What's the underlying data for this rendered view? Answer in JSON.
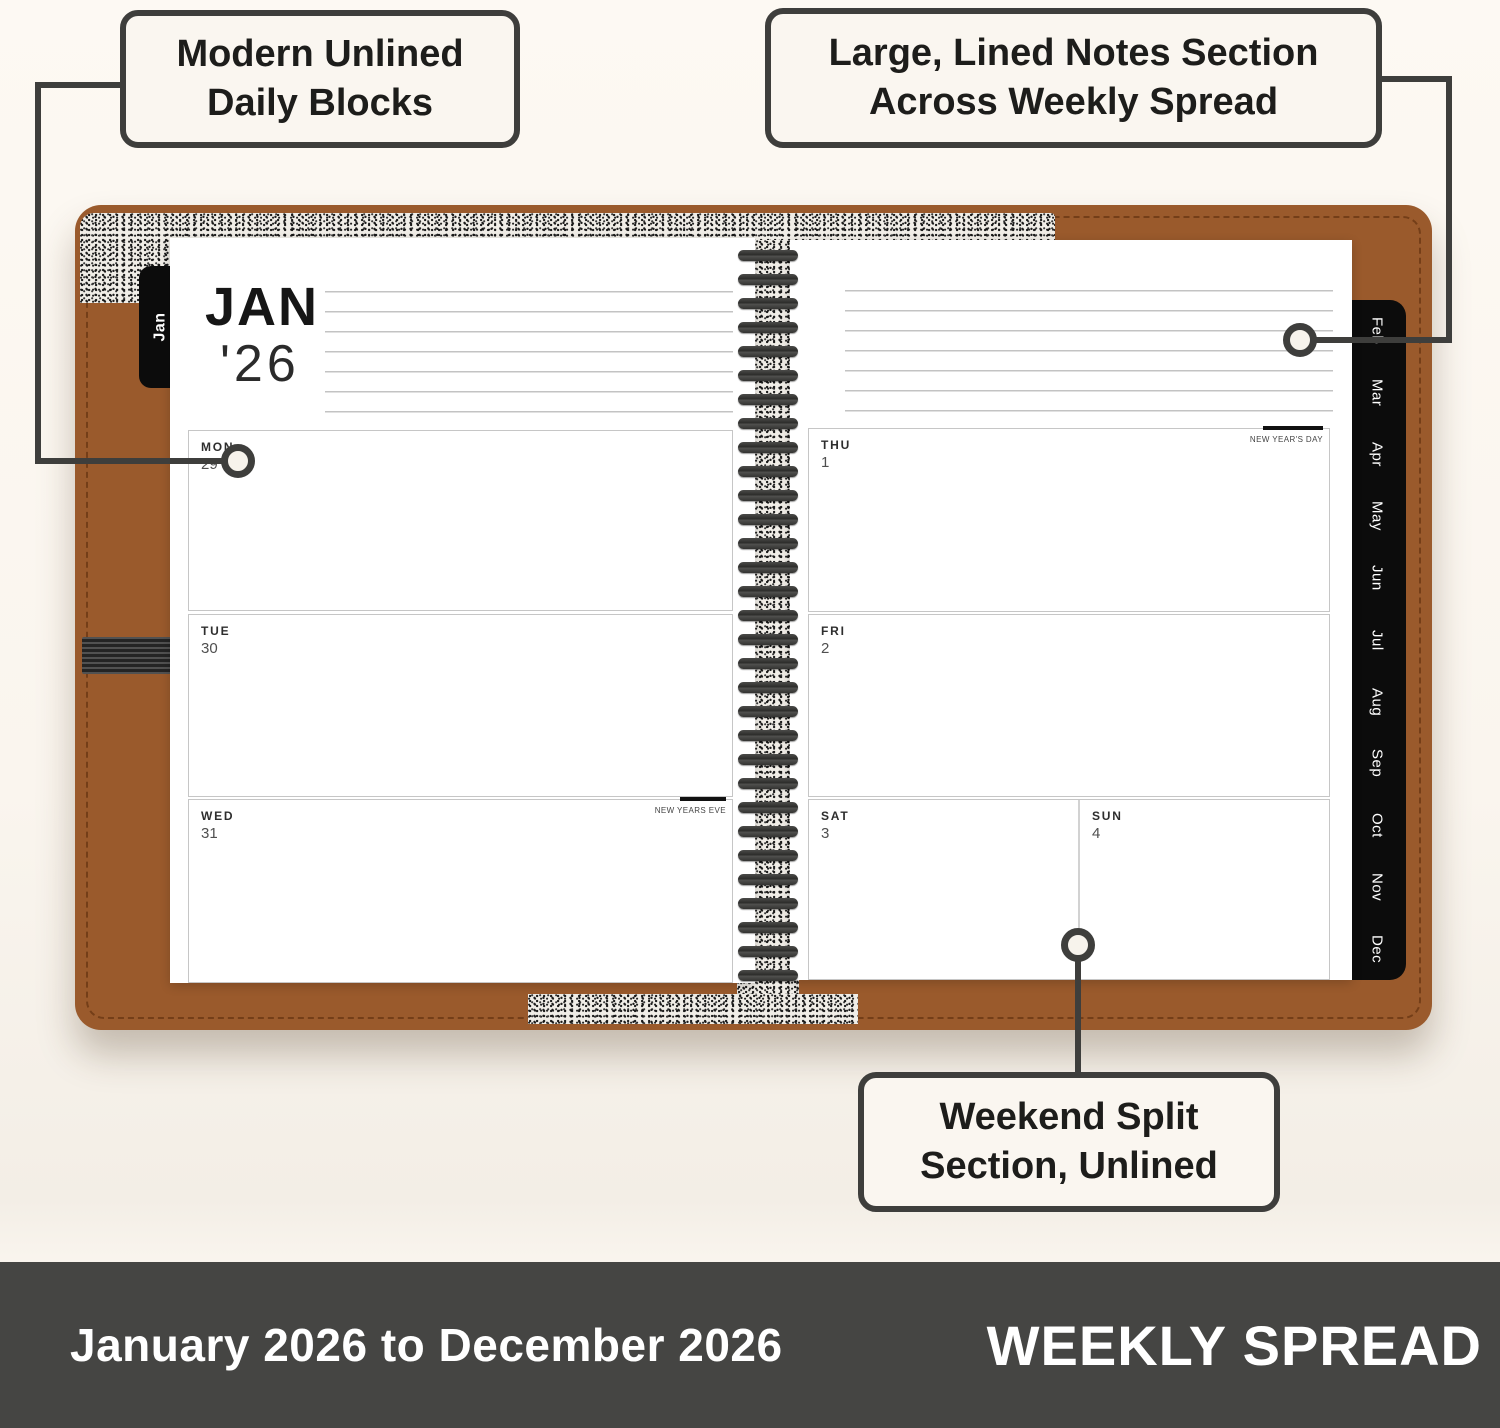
{
  "callouts": {
    "daily_blocks": {
      "line1": "Modern Unlined",
      "line2": "Daily Blocks"
    },
    "notes_section": {
      "line1": "Large, Lined Notes Section",
      "line2": "Across Weekly Spread"
    },
    "weekend_split": {
      "line1": "Weekend Split",
      "line2": "Section, Unlined"
    }
  },
  "planner": {
    "current_tab": "Jan",
    "month_tabs": [
      "Feb",
      "Mar",
      "Apr",
      "May",
      "Jun",
      "Jul",
      "Aug",
      "Sep",
      "Oct",
      "Nov",
      "Dec"
    ],
    "header": {
      "month": "JAN",
      "year": "'26"
    },
    "days": {
      "mon": {
        "label": "MON",
        "date": "29"
      },
      "tue": {
        "label": "TUE",
        "date": "30"
      },
      "wed": {
        "label": "WED",
        "date": "31",
        "holiday": "NEW YEARS EVE"
      },
      "thu": {
        "label": "THU",
        "date": "1",
        "holiday": "NEW YEAR'S DAY"
      },
      "fri": {
        "label": "FRI",
        "date": "2"
      },
      "sat": {
        "label": "SAT",
        "date": "3"
      },
      "sun": {
        "label": "SUN",
        "date": "4"
      }
    }
  },
  "footer": {
    "date_range": "January 2026 to December 2026",
    "spread_type": "WEEKLY SPREAD"
  },
  "colors": {
    "leather": "#9a5a2c",
    "footer_bg": "#454543",
    "connector": "#3e3e3c",
    "background": "#faf5ee"
  }
}
